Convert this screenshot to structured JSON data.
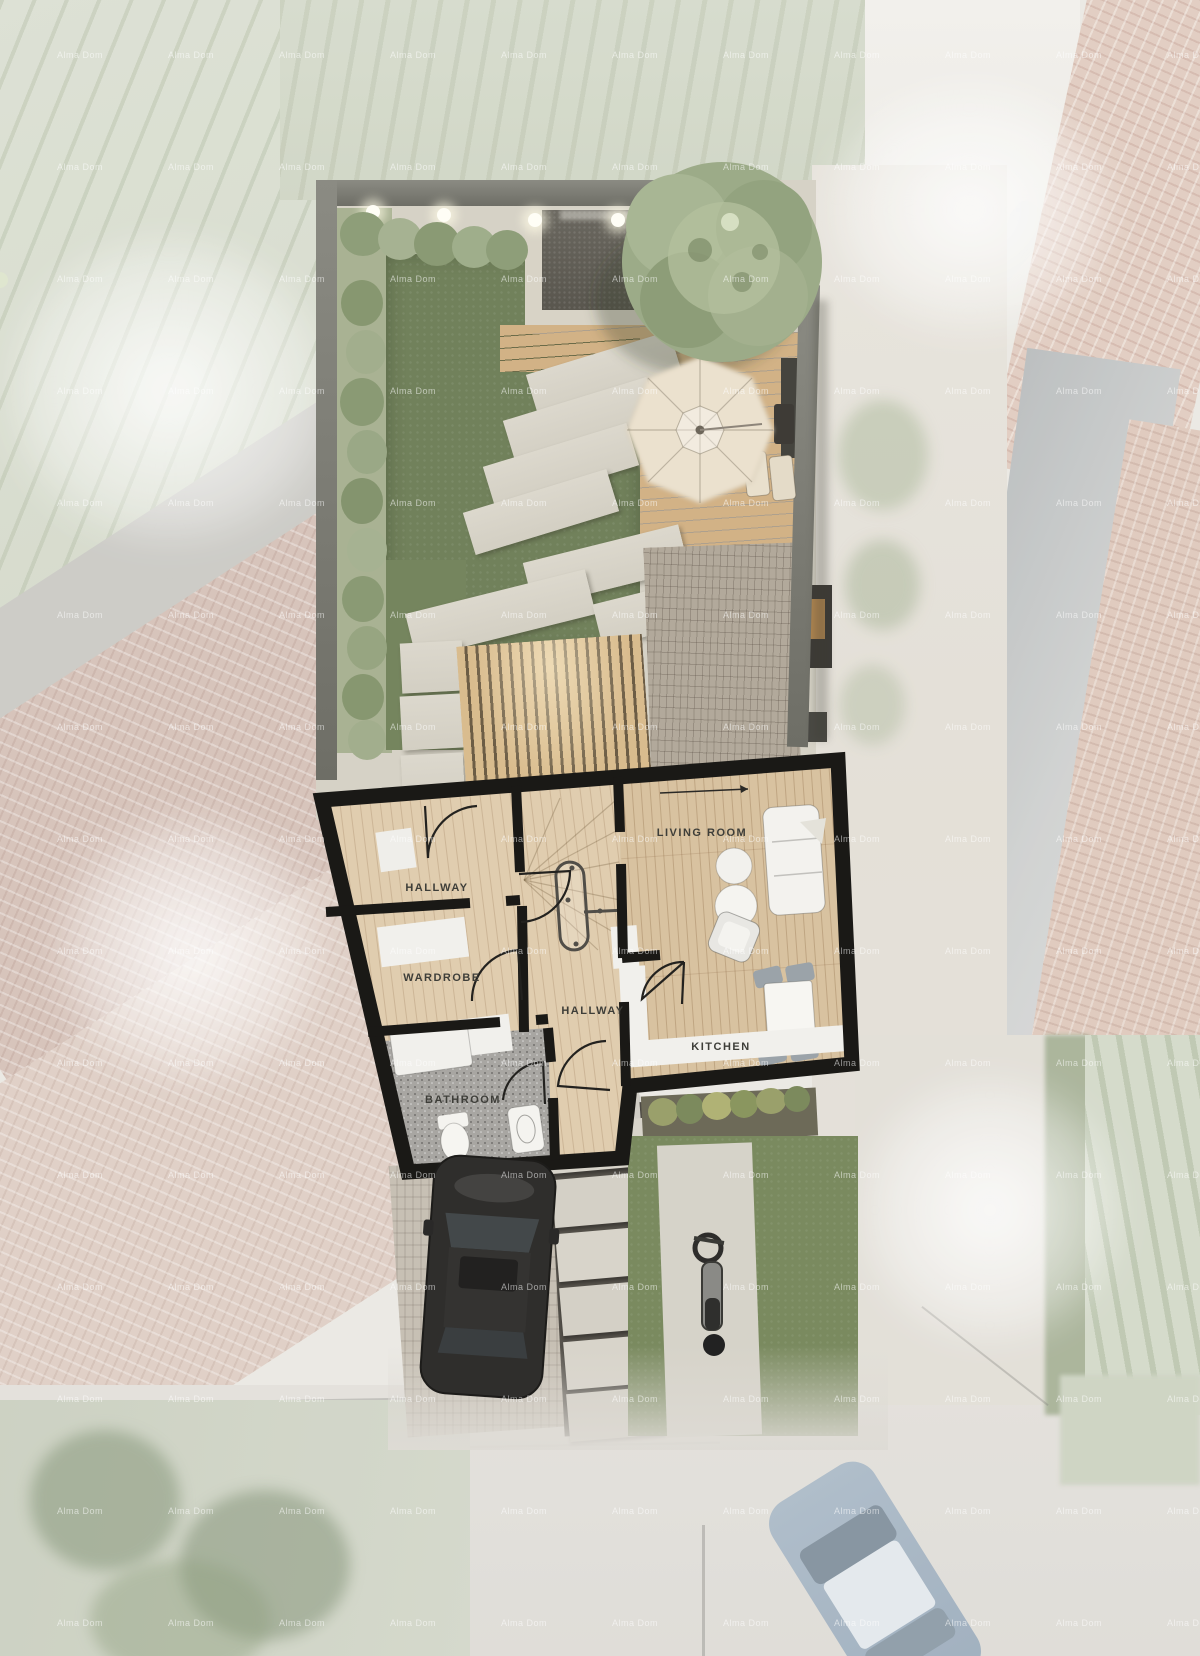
{
  "watermark": {
    "text": "Alma Dom",
    "color": "#ffffff"
  },
  "plan": {
    "rooms": [
      {
        "id": "hallway-upper",
        "label": "HALLWAY"
      },
      {
        "id": "wardrobe",
        "label": "WARDROBE"
      },
      {
        "id": "hallway-central",
        "label": "HALLWAY"
      },
      {
        "id": "living-room",
        "label": "LIVING ROOM"
      },
      {
        "id": "kitchen",
        "label": "KITCHEN"
      },
      {
        "id": "bathroom",
        "label": "BATHROOM"
      }
    ]
  },
  "colors": {
    "wall_black": "#1a1916",
    "wood_floor": "#d8c2a0",
    "hallway_floor": "#e0cdaf",
    "bathroom_floor": "#a8a6a2",
    "grass": "#71815b",
    "deck_wood": "#d2b286",
    "paver": "#d8d4ca",
    "brick_paving": "#b2a99b",
    "garden_wall_grey": "#6e6e66",
    "umbrella_cream": "#ebe1ce",
    "tree_green": "#9cab88",
    "car_dark": "#2f2e2c",
    "faded_roof_terracotta": "#d9c6bb",
    "road_grey": "#dedbd5"
  }
}
